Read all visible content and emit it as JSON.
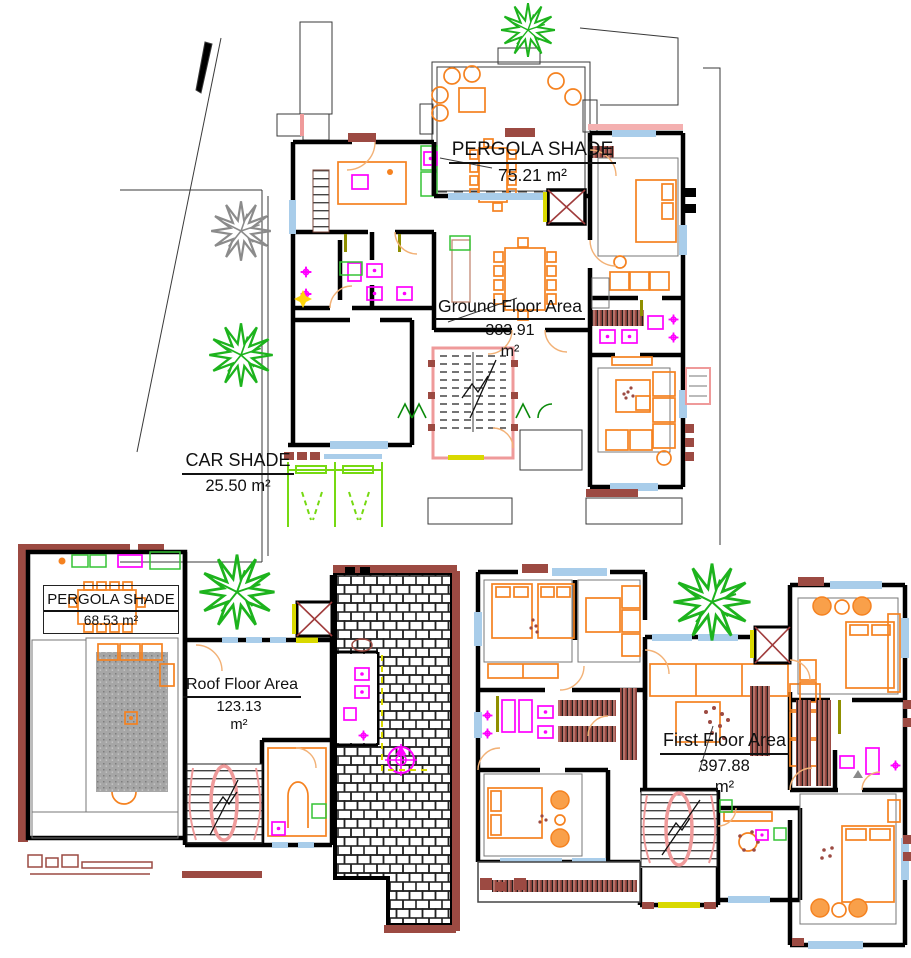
{
  "document": {
    "type": "architectural floor plan sheet",
    "sheet_background": "#ffffff"
  },
  "plans": [
    {
      "id": "ground-floor",
      "area_label": "Ground Floor Area",
      "area_value": "383.91",
      "area_unit": "m²",
      "annotations": [
        {
          "id": "pergola-shade",
          "label": "PERGOLA SHADE",
          "value": "75.21 m²"
        },
        {
          "id": "car-shade",
          "label": "CAR SHADE",
          "value": "25.50 m²"
        }
      ]
    },
    {
      "id": "roof-floor",
      "area_label": "Roof Floor Area",
      "area_value": "123.13",
      "area_unit": "m²",
      "annotations": [
        {
          "id": "pergola-shade",
          "label": "PERGOLA SHADE",
          "value": "68.53 m²"
        }
      ]
    },
    {
      "id": "first-floor",
      "area_label": "First Floor Area",
      "area_value": "397.88",
      "area_unit": "m²",
      "annotations": []
    }
  ],
  "colors": {
    "walls": "#000000",
    "furniture": "#f58220",
    "plumbing_fixtures": "#ff00ff",
    "vegetation": "#1db31d",
    "vegetation_shadow": "#8b8b8b",
    "masonry_parapet": "#9c4a42",
    "glazing": "#a9cdea",
    "parking_markings": "#76d912",
    "stair_rail": "#ef9a9a",
    "door_swings": "#f2b176",
    "sills": "#d9d900"
  }
}
